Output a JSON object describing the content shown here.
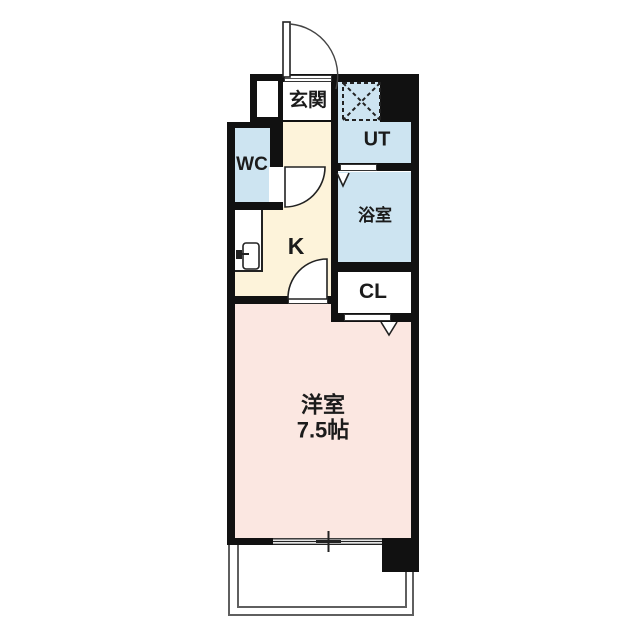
{
  "rooms": {
    "genkan": {
      "label": "玄関"
    },
    "utility": {
      "label": "UT"
    },
    "toilet": {
      "label": "WC"
    },
    "bathroom": {
      "label": "浴室"
    },
    "kitchen": {
      "label": "K"
    },
    "closet": {
      "label": "CL"
    },
    "western_room": {
      "label": "洋室",
      "size": "7.5帖"
    }
  },
  "colors": {
    "wall": "#111111",
    "wet_area_fill": "#cde4f1",
    "kitchen_hall_fill": "#fdf3da",
    "western_room_fill": "#fbe7e1",
    "closet_fill": "#ffffff",
    "balcony_line": "#5f5f5f",
    "detail_line": "#222222"
  }
}
